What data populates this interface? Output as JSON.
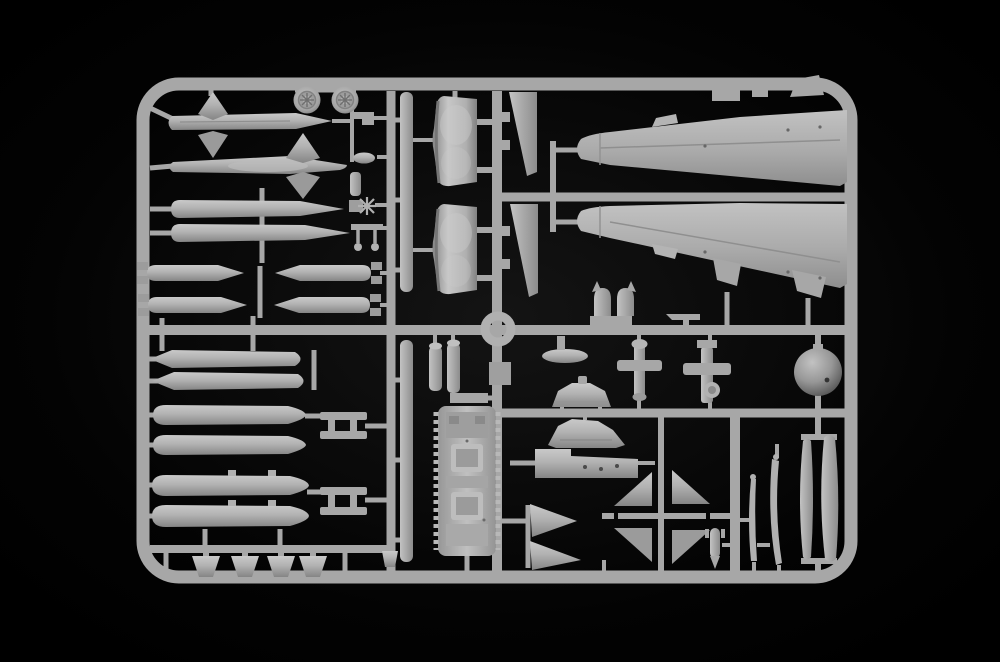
{
  "scene": {
    "description": "Photograph of a light-gray injection-molded plastic model kit sprue (parts frame) of an aircraft kit, lying on a plain black background",
    "subject": "model kit sprue with aircraft parts",
    "orientation": "landscape"
  },
  "colors": {
    "background": "#000000",
    "plastic": "#a7a7a7",
    "plastic_light": "#c6c6c6",
    "plastic_dark": "#7d7d7d",
    "void": "#000000"
  },
  "counts": {
    "wheels": 2,
    "missiles": 2,
    "slender_tanks": 2,
    "bombs": 4,
    "drop_tanks": 6,
    "bottom_fins": 4,
    "air_intakes": 2,
    "fuselage_halves": 2,
    "canopy_halves": 2,
    "cross_struts": 2
  },
  "part_labels": [
    "rounded rectangular sprue frame",
    "vertical and horizontal runners",
    "two spoked wheels",
    "two finned missiles",
    "two slender pointed tanks",
    "four bombs with box tail fins",
    "six cigar-shaped drop tanks",
    "two H-shaped pylons",
    "four trapezoid intake ramps",
    "two long flat rails",
    "two curved air intake ducts",
    "two tall fin panels",
    "ring part",
    "two tapered fuselage halves with tabs",
    "twin-ear antenna part",
    "cluster of small fittings",
    "two small cylinders and a square box",
    "ribbed cockpit tub with two seats",
    "flat oval canopy base",
    "windscreen profile part",
    "canopy frame part",
    "flat panel with holes",
    "two triangular ramp fins",
    "pinwheel of four stabilizer fins",
    "small finned bomb",
    "two thin blade strips",
    "two long canopy halves",
    "spherical radome ball",
    "two cross-shaped gear struts"
  ]
}
